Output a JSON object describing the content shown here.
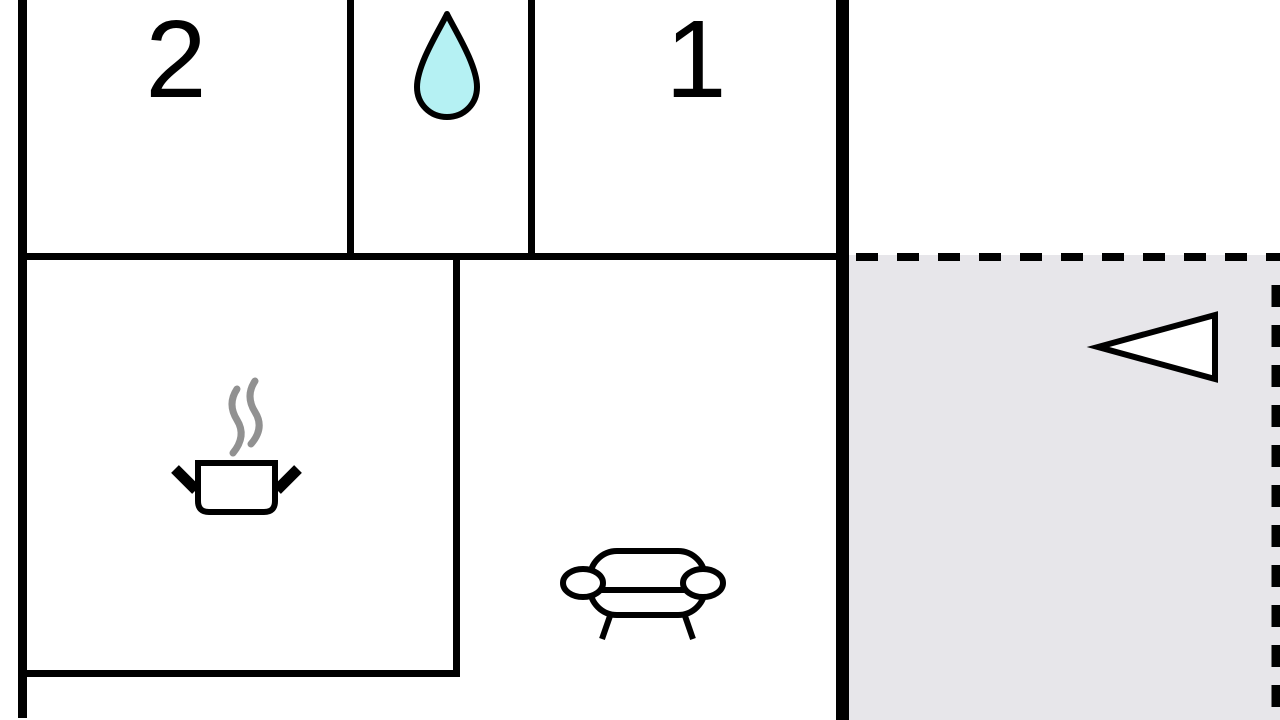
{
  "rooms": {
    "bedroom2": {
      "label": "2"
    },
    "bedroom1": {
      "label": "1"
    },
    "bathroom": {
      "icon": "water-drop"
    },
    "kitchen": {
      "icon": "cooking-pot-with-steam"
    },
    "living_room": {
      "icon": "sofa"
    },
    "terrace": {
      "icon": "entrance-direction-arrow"
    }
  },
  "colors": {
    "wall": "#000000",
    "floor": "#ffffff",
    "terrace_fill": "#e7e6ea",
    "water_drop_fill": "#b5f1f3",
    "steam": "#919191",
    "icon_fill": "#ffffff",
    "label_text": "#000000"
  }
}
